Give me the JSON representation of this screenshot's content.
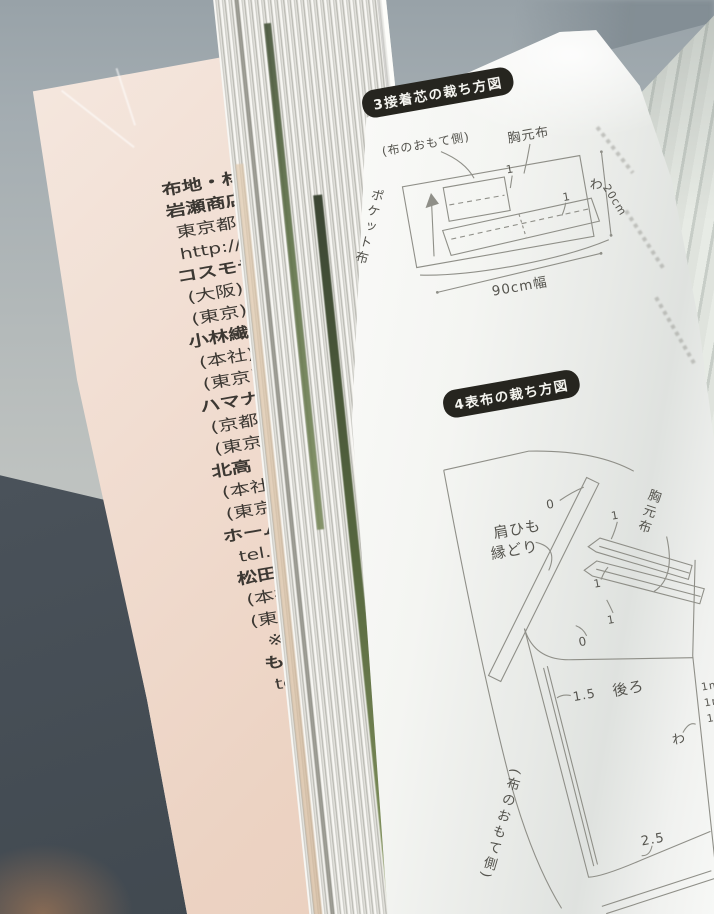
{
  "left_page": {
    "lines": [
      {
        "t": "布地・材",
        "b": true
      },
      {
        "t": "岩瀬商店",
        "b": true
      },
      {
        "t": "東京都荒",
        "b": false
      },
      {
        "t": "http://www",
        "b": false
      },
      {
        "t": "コスモテ",
        "b": true
      },
      {
        "t": "(大阪)大阪",
        "b": false
      },
      {
        "t": "(東京)東京",
        "b": false
      },
      {
        "t": "小林繊維(",
        "b": true
      },
      {
        "t": "(本社)大阪",
        "b": false
      },
      {
        "t": "(東京)東京",
        "b": false
      },
      {
        "t": "ハマナカ",
        "b": true
      },
      {
        "t": "(京都本社",
        "b": false
      },
      {
        "t": "(東京支店",
        "b": false
      },
      {
        "t": "北高",
        "b": true
      },
      {
        "t": "(本社)大",
        "b": false
      },
      {
        "t": "(東京)東",
        "b": false
      },
      {
        "t": "ホームク",
        "b": true
      },
      {
        "t": "tel.03-58",
        "b": false
      },
      {
        "t": "松田輪商",
        "b": true
      },
      {
        "t": "(本社)大",
        "b": false
      },
      {
        "t": "(東京)東",
        "b": false
      },
      {
        "t": "※松田輪",
        "b": false
      },
      {
        "t": "もめんや",
        "b": true
      },
      {
        "t": "tel.&fax0",
        "b": false
      }
    ]
  },
  "right_page": {
    "section3": {
      "title": "3接着芯の裁ち方図",
      "fabric_side_label": "(布のおもて側)",
      "chest_piece_label": "胸元布",
      "pocket_piece_label": "ポケット布",
      "fold_label": "わ",
      "height_dim": "20cm",
      "width_dim": "90cm幅",
      "seam_1a": "1",
      "seam_1b": "1"
    },
    "section4": {
      "title": "4表布の裁ち方図",
      "strap_label_line1": "肩ひも",
      "strap_label_line2": "縁どり",
      "chest_piece_label": "胸元布",
      "back_piece_label": "後ろ",
      "fabric_side_label": "(布のおもて側)",
      "fold_label": "わ",
      "dim_zero_top": "0",
      "dim_zero_mid": "0",
      "seam_1a": "1",
      "seam_1b": "1",
      "seam_1c": "1",
      "seam_left": "1.5",
      "seam_bottom": "2.5",
      "edge_notes": [
        "1m",
        "1m",
        "1"
      ]
    }
  },
  "colors": {
    "badge_bg": "#26251f",
    "badge_text": "#f4f4ef",
    "diagram_line": "#8f8f88",
    "left_page_tint": "#eed7c8",
    "table_surface": "#49525a",
    "wall": "#a3acb1"
  }
}
